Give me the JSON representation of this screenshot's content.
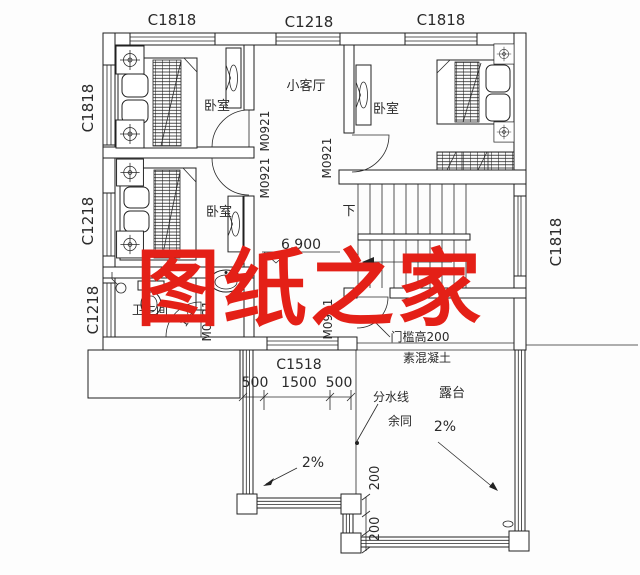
{
  "watermark": {
    "text": "图纸之家",
    "color": "#e42017"
  },
  "windows": {
    "top_left": "C1818",
    "top_center": "C1218",
    "top_right": "C1818",
    "left_upper": "C1818",
    "left_middle": "C1218",
    "left_lower": "C1218",
    "right": "C1818",
    "south": "C1518"
  },
  "doors": {
    "bedroom1": "M0921",
    "bedroom2": "M0921",
    "bedroom3": "M0921",
    "terrace": "M0921",
    "bathroom": "M0821"
  },
  "rooms": {
    "bedroom1": "卧室",
    "bedroom2": "卧室",
    "bedroom3": "卧室",
    "living": "小客厅",
    "bathroom": "卫生间",
    "terrace": "露台"
  },
  "stairs": {
    "direction": "下"
  },
  "level": {
    "value": "6.900"
  },
  "dimensions": {
    "south": [
      "500",
      "1500",
      "500"
    ],
    "steps": [
      "200",
      "200"
    ]
  },
  "annotations": {
    "threshold": "门槛高200",
    "concrete": "素混凝土",
    "water_line": "分水线",
    "same_as": "余同",
    "slope_left": "2%",
    "slope_right": "2%",
    "slope_bath": "1%"
  }
}
